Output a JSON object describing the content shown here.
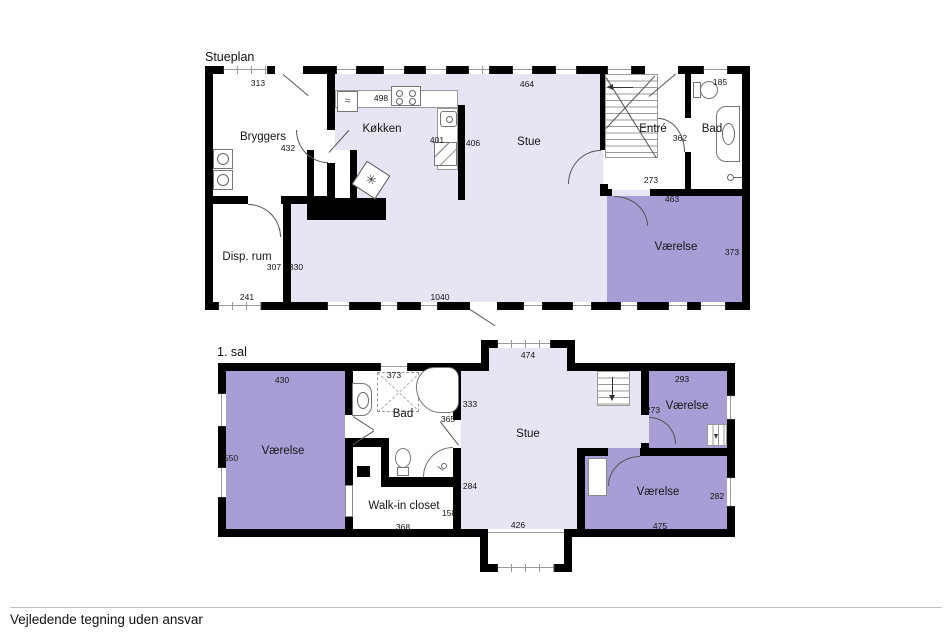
{
  "titles": {
    "ground": "Stueplan",
    "first": "1. sal"
  },
  "footer": {
    "disclaimer": "Vejledende tegning uden ansvar"
  },
  "ground": {
    "rooms": {
      "bryggers": "Bryggers",
      "disp": "Disp. rum",
      "kokken": "Køkken",
      "stue": "Stue",
      "entre": "Entré",
      "bad": "Bad",
      "vaerelse": "Værelse"
    },
    "dims": {
      "bryggers_w": "313",
      "bryggers_door": "432",
      "disp_h": "307",
      "disp_w": "241",
      "stue_w_left": "330",
      "kokken_w": "498",
      "kokken_counter": "401",
      "kokken_h": "406",
      "stue_w": "464",
      "bottom_w": "1040",
      "entre_h": "362",
      "entre_w": "273",
      "bad_w": "185",
      "vaerelse_w": "463",
      "vaerelse_h": "373"
    }
  },
  "first": {
    "rooms": {
      "vaerelse_left": "Værelse",
      "bad": "Bad",
      "walkin": "Walk-in closet",
      "stue": "Stue",
      "vaerelse_ne": "Værelse",
      "vaerelse_se": "Værelse"
    },
    "dims": {
      "vaerelse_left_w": "430",
      "vaerelse_left_h": "550",
      "bad_w": "373",
      "bad_h": "365",
      "stue_h_top": "333",
      "stue_h_bottom": "284",
      "walkin_h": "158",
      "walkin_w": "368",
      "stue_w_top": "474",
      "stue_w_bottom": "426",
      "vaerelse_ne_w": "293",
      "vaerelse_ne_h": "273",
      "vaerelse_se_w": "475",
      "vaerelse_se_h": "282"
    }
  },
  "icons": {
    "washer_wave": "≈",
    "stove_glyph": "✳"
  },
  "colors": {
    "room_light": "#e7e4f3",
    "room_purple": "#a89dd4",
    "wall": "#000000"
  }
}
